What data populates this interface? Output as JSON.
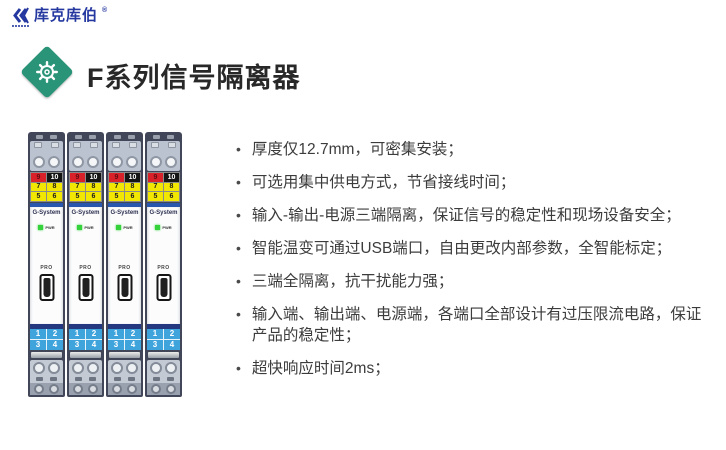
{
  "logo": {
    "name": "库克库伯",
    "reg": "®"
  },
  "header": {
    "title": "F系列信号隔离器"
  },
  "features": {
    "bullet_char": "•",
    "items": [
      "厚度仅12.7mm，可密集安装；",
      "可选用集中供电方式，节省接线时间；",
      "输入-输出-电源三端隔离，保证信号的稳定性和现场设备安全；",
      "智能温变可通过USB端口，自由更改内部参数，全智能标定；",
      "三端全隔离，抗干扰能力强；",
      "输入端、输出端、电源端，各端口全部设计有过压限流电路，保证产品的稳定性；",
      "超快响应时间2ms；"
    ]
  },
  "module": {
    "count": 4,
    "brand": "G-System",
    "pwr_label": "PWR",
    "pro_label": "PRO",
    "top_cells": [
      "9",
      "10",
      "7",
      "8",
      "5",
      "6"
    ],
    "bottom_cells": [
      "1",
      "2",
      "3",
      "4"
    ]
  },
  "colors": {
    "logo_blue": "#2438a0",
    "title_text": "#282828",
    "diamond_green": "#2a9478",
    "feature_text": "#3c3c3c",
    "module_housing": "#414659",
    "module_red": "#d92129",
    "module_black": "#151515",
    "module_yellow": "#f2e603",
    "module_blue_stripe": "#2a57ae",
    "module_light_blue": "#3fa3dc",
    "pwr_green": "#35d23c"
  }
}
